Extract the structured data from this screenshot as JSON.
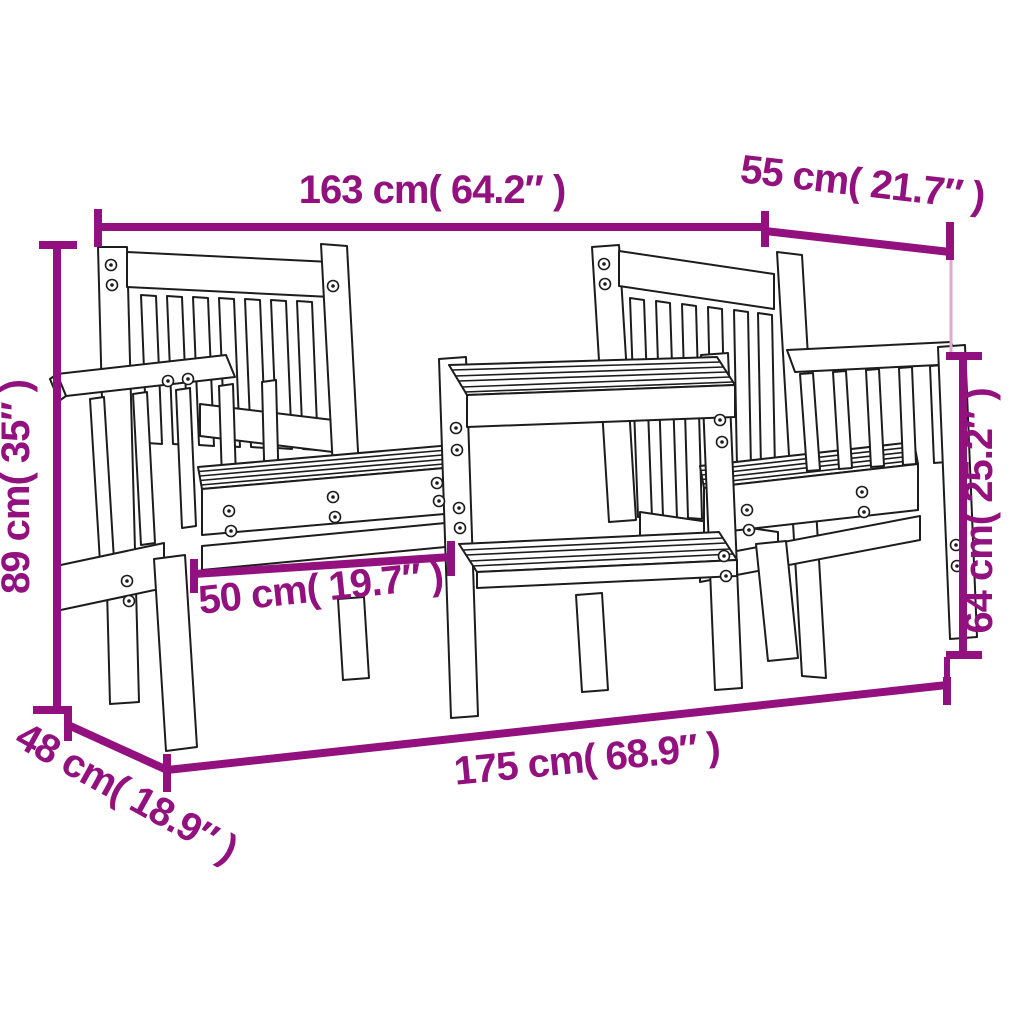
{
  "page": {
    "type": "product-dimension-diagram",
    "subject": "2-seater garden bench with centre table, line drawing with measurements",
    "background": "#ffffff"
  },
  "colors": {
    "dimension_accent": "#93117E",
    "dimension_connector_light": "#E3A7D3",
    "line_art": "#1c1c1c"
  },
  "dimensions": {
    "top_width": {
      "label": "163 cm( 64.2″ )"
    },
    "top_depth": {
      "label": "55 cm( 21.7″ )"
    },
    "left_height": {
      "label": "89 cm( 35″ )"
    },
    "right_height": {
      "label": "64 cm( 25.2″ )"
    },
    "seat_width": {
      "label": "50 cm( 19.7″ )"
    },
    "bottom_depth": {
      "label": "48 cm( 18.9″ )"
    },
    "bottom_width": {
      "label": "175 cm( 68.9″ )"
    }
  }
}
